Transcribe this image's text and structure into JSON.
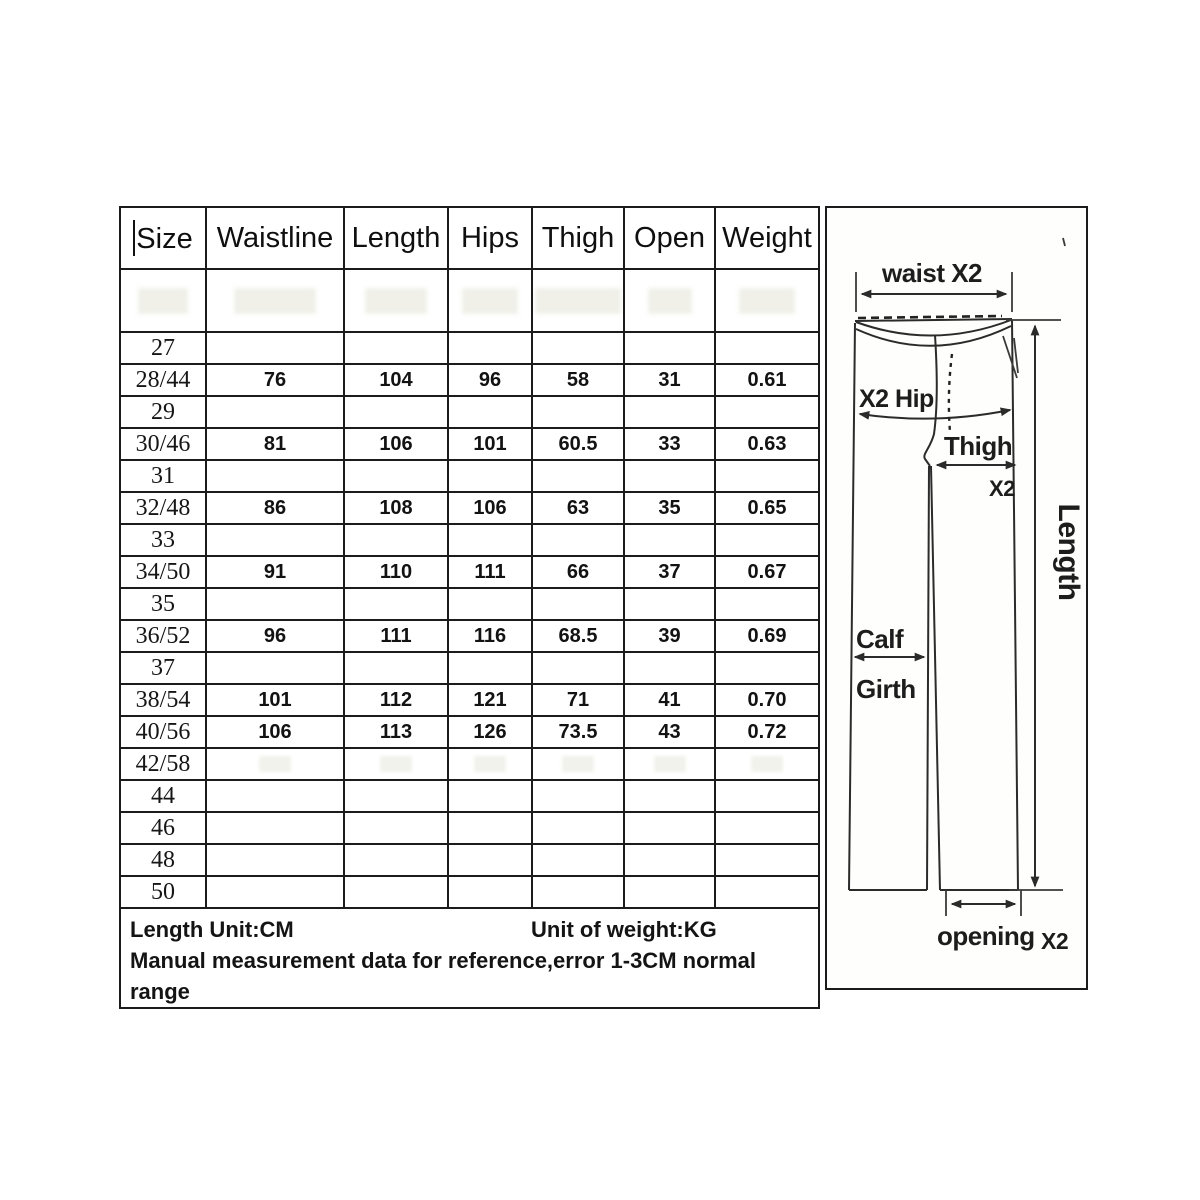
{
  "table": {
    "headers": [
      "Size",
      "Waistline",
      "Length",
      "Hips",
      "Thigh",
      "Open",
      "Weight"
    ],
    "rows": [
      {
        "size": "27",
        "waistline": "",
        "length": "",
        "hips": "",
        "thigh": "",
        "open": "",
        "weight": ""
      },
      {
        "size": "28/44",
        "waistline": "76",
        "length": "104",
        "hips": "96",
        "thigh": "58",
        "open": "31",
        "weight": "0.61"
      },
      {
        "size": "29",
        "waistline": "",
        "length": "",
        "hips": "",
        "thigh": "",
        "open": "",
        "weight": ""
      },
      {
        "size": "30/46",
        "waistline": "81",
        "length": "106",
        "hips": "101",
        "thigh": "60.5",
        "open": "33",
        "weight": "0.63"
      },
      {
        "size": "31",
        "waistline": "",
        "length": "",
        "hips": "",
        "thigh": "",
        "open": "",
        "weight": ""
      },
      {
        "size": "32/48",
        "waistline": "86",
        "length": "108",
        "hips": "106",
        "thigh": "63",
        "open": "35",
        "weight": "0.65"
      },
      {
        "size": "33",
        "waistline": "",
        "length": "",
        "hips": "",
        "thigh": "",
        "open": "",
        "weight": ""
      },
      {
        "size": "34/50",
        "waistline": "91",
        "length": "110",
        "hips": "111",
        "thigh": "66",
        "open": "37",
        "weight": "0.67"
      },
      {
        "size": "35",
        "waistline": "",
        "length": "",
        "hips": "",
        "thigh": "",
        "open": "",
        "weight": ""
      },
      {
        "size": "36/52",
        "waistline": "96",
        "length": "111",
        "hips": "116",
        "thigh": "68.5",
        "open": "39",
        "weight": "0.69"
      },
      {
        "size": "37",
        "waistline": "",
        "length": "",
        "hips": "",
        "thigh": "",
        "open": "",
        "weight": ""
      },
      {
        "size": "38/54",
        "waistline": "101",
        "length": "112",
        "hips": "121",
        "thigh": "71",
        "open": "41",
        "weight": "0.70"
      },
      {
        "size": "40/56",
        "waistline": "106",
        "length": "113",
        "hips": "126",
        "thigh": "73.5",
        "open": "43",
        "weight": "0.72"
      },
      {
        "size": "42/58",
        "ghost_values": true,
        "waistline": "",
        "length": "",
        "hips": "",
        "thigh": "",
        "open": "",
        "weight": ""
      },
      {
        "size": "44",
        "waistline": "",
        "length": "",
        "hips": "",
        "thigh": "",
        "open": "",
        "weight": ""
      },
      {
        "size": "46",
        "waistline": "",
        "length": "",
        "hips": "",
        "thigh": "",
        "open": "",
        "weight": ""
      },
      {
        "size": "48",
        "waistline": "",
        "length": "",
        "hips": "",
        "thigh": "",
        "open": "",
        "weight": ""
      },
      {
        "size": "50",
        "waistline": "",
        "length": "",
        "hips": "",
        "thigh": "",
        "open": "",
        "weight": ""
      }
    ],
    "footer": {
      "length_unit": "Length Unit:CM",
      "weight_unit": "Unit of weight:KG",
      "note": "Manual measurement data for reference,error 1-3CM normal range"
    }
  },
  "diagram": {
    "labels": {
      "waist": "waist X2",
      "hip": "X2 Hip",
      "thigh": "Thigh",
      "thigh_x2": "X2",
      "length": "Length",
      "calf": "Calf",
      "girth": "Girth",
      "opening": "opening",
      "opening_x2": "X2"
    },
    "line_color": "#2b2b2b"
  }
}
